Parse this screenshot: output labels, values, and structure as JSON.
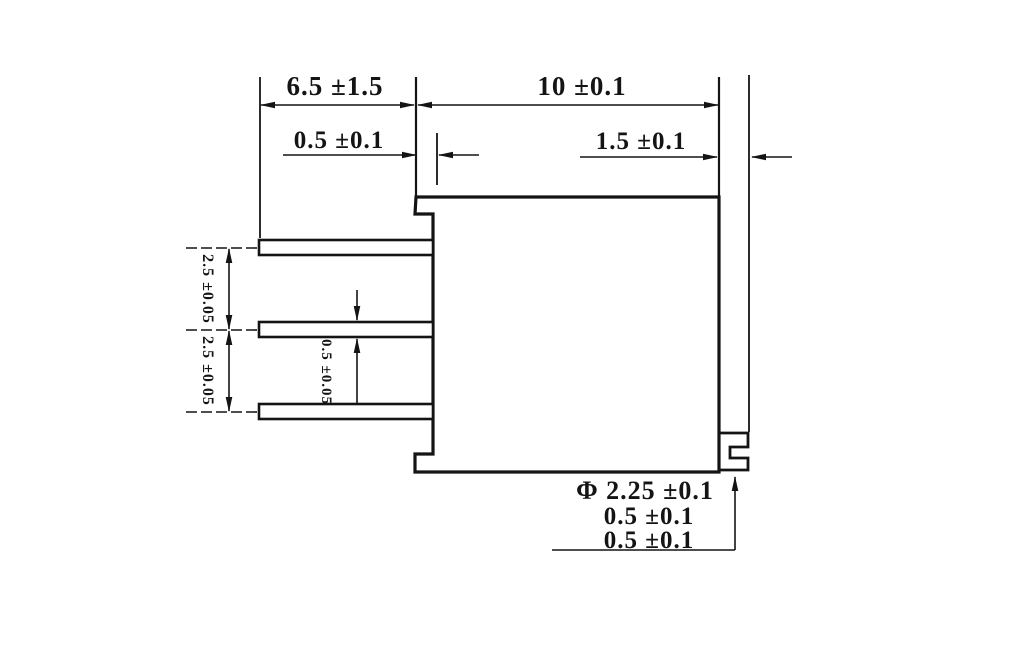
{
  "colors": {
    "background": "#ffffff",
    "line": "#141414"
  },
  "labels": {
    "top_left": "6.5 ±1.5",
    "top_right": "10 ±0.1",
    "mid_left": "0.5 ±0.1",
    "mid_right": "1.5 ±0.1",
    "pitch_upper": "2.5 ±0.05",
    "pitch_lower": "2.5 ±0.05",
    "pin_thickness": "0.5 ±0.05",
    "callout_line1": "Φ 2.25 ±0.1",
    "callout_line2": "0.5 ±0.1",
    "callout_line3": "0.5 ±0.1"
  }
}
